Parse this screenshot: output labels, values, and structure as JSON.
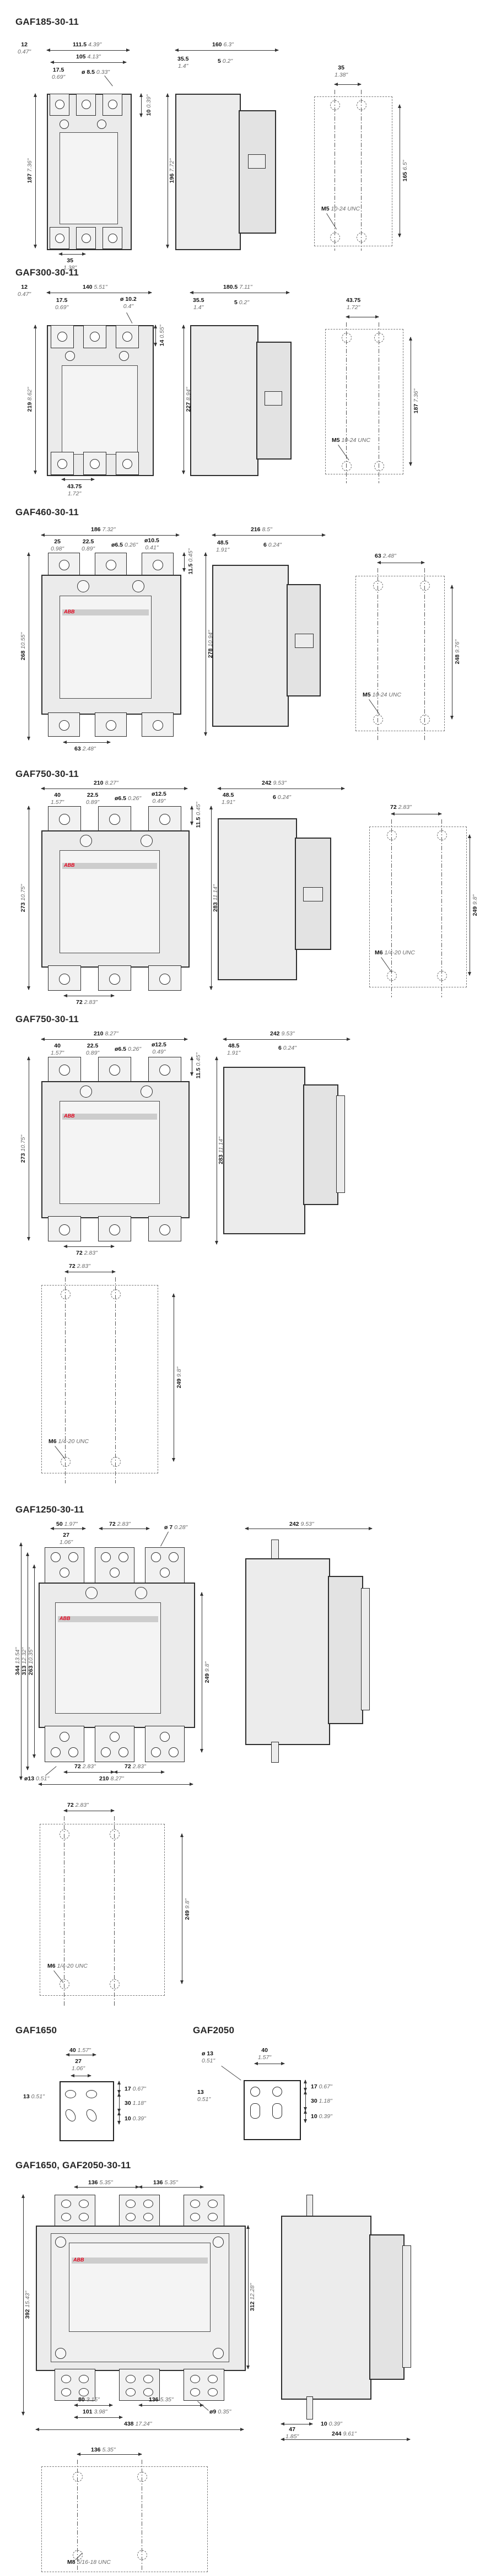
{
  "page": {
    "bg": "#ffffff",
    "ink": "#2e2e2e",
    "fill": "#ebebeb",
    "accent_red": "#e2001a",
    "logo": "ABB"
  },
  "sections": [
    {
      "title": "GAF185-30-11",
      "front": {
        "off": [
          "12",
          "0.47\""
        ],
        "w1": [
          "111.5",
          "4.39\""
        ],
        "w2": [
          "105",
          "4.13\""
        ],
        "pitch": [
          "17.5",
          "0.69\""
        ],
        "hole": [
          "ø 8.5",
          "0.33\""
        ],
        "top": [
          "10",
          "0.39\""
        ],
        "h": [
          "187",
          "7.36\""
        ],
        "bot": [
          "35",
          "1.38\""
        ]
      },
      "side": {
        "w": [
          "160",
          "6.3\""
        ],
        "a": [
          "35.5",
          "1.4\""
        ],
        "b": [
          "5",
          "0.2\""
        ],
        "h": [
          "196",
          "7.72\""
        ]
      },
      "mount": {
        "pitch": [
          "35",
          "1.38\""
        ],
        "h": [
          "165",
          "6.5\""
        ],
        "thread": [
          "M5",
          "10-24 UNC"
        ]
      }
    },
    {
      "title": "GAF300-30-11",
      "front": {
        "off": [
          "12",
          "0.47\""
        ],
        "w1": [
          "140",
          "5.51\""
        ],
        "pitch": [
          "17.5",
          "0.69\""
        ],
        "hole": [
          "ø 10.2",
          "0.4\""
        ],
        "top": [
          "14",
          "0.55\""
        ],
        "h": [
          "219",
          "8.62\""
        ],
        "bot": [
          "43.75",
          "1.72\""
        ]
      },
      "side": {
        "w": [
          "180.5",
          "7.11\""
        ],
        "a": [
          "35.5",
          "1.4\""
        ],
        "b": [
          "5",
          "0.2\""
        ],
        "h": [
          "227",
          "8.94\""
        ]
      },
      "mount": {
        "pitch": [
          "43.75",
          "1.72\""
        ],
        "h": [
          "187",
          "7.36\""
        ],
        "thread": [
          "M5",
          "10-24 UNC"
        ]
      }
    },
    {
      "title": "GAF460-30-11",
      "front": {
        "w1": [
          "186",
          "7.32\""
        ],
        "p1": [
          "25",
          "0.98\""
        ],
        "p2": [
          "22.5",
          "0.89\""
        ],
        "hole1": [
          "ø6.5",
          "0.26\""
        ],
        "hole2": [
          "ø10.5",
          "0.41\""
        ],
        "top": [
          "11.5",
          "0.45\""
        ],
        "h": [
          "268",
          "10.55\""
        ],
        "bot": [
          "63",
          "2.48\""
        ]
      },
      "side": {
        "w": [
          "216",
          "8.5\""
        ],
        "a": [
          "48.5",
          "1.91\""
        ],
        "b": [
          "6",
          "0.24\""
        ],
        "h": [
          "278",
          "10.94\""
        ]
      },
      "mount": {
        "pitch": [
          "63",
          "2.48\""
        ],
        "h": [
          "248",
          "9.76\""
        ],
        "thread": [
          "M5",
          "10-24 UNC"
        ]
      }
    },
    {
      "title": "GAF750-30-11",
      "front": {
        "w1": [
          "210",
          "8.27\""
        ],
        "p1": [
          "40",
          "1.57\""
        ],
        "p2": [
          "22.5",
          "0.89\""
        ],
        "hole1": [
          "ø6.5",
          "0.26\""
        ],
        "hole2": [
          "ø12.5",
          "0.49\""
        ],
        "top": [
          "11.5",
          "0.45\""
        ],
        "h": [
          "273",
          "10.75\""
        ],
        "bot": [
          "72",
          "2.83\""
        ]
      },
      "side": {
        "w": [
          "242",
          "9.53\""
        ],
        "a": [
          "48.5",
          "1.91\""
        ],
        "b": [
          "6",
          "0.24\""
        ],
        "h": [
          "283",
          "11.14\""
        ]
      },
      "mount": {
        "pitch": [
          "72",
          "2.83\""
        ],
        "h": [
          "249",
          "9.8\""
        ],
        "thread": [
          "M6",
          "1/4-20 UNC"
        ]
      }
    },
    {
      "title": "GAF750-30-11",
      "front": {
        "w1": [
          "210",
          "8.27\""
        ],
        "p1": [
          "40",
          "1.57\""
        ],
        "p2": [
          "22.5",
          "0.89\""
        ],
        "hole1": [
          "ø6.5",
          "0.26\""
        ],
        "hole2": [
          "ø12.5",
          "0.49\""
        ],
        "top": [
          "11.5",
          "0.45\""
        ],
        "h": [
          "273",
          "10.75\""
        ],
        "bot": [
          "72",
          "2.83\""
        ]
      },
      "side": {
        "w": [
          "242",
          "9.53\""
        ],
        "a": [
          "48.5",
          "1.91\""
        ],
        "b": [
          "6",
          "0.24\""
        ],
        "h": [
          "283",
          "11.14\""
        ]
      },
      "mount": {
        "pitch": [
          "72",
          "2.83\""
        ],
        "h": [
          "249",
          "9.8\""
        ],
        "thread": [
          "M6",
          "1/4-20 UNC"
        ]
      }
    },
    {
      "title": "GAF1250-30-11",
      "front": {
        "p50": [
          "50",
          "1.97\""
        ],
        "p27": [
          "27",
          "1.06\""
        ],
        "p72": [
          "72",
          "2.83\""
        ],
        "hole7": [
          "ø 7",
          "0.28\""
        ],
        "h344": [
          "344",
          "13.54\""
        ],
        "h313": [
          "313",
          "12.32\""
        ],
        "h263": [
          "263",
          "10.35\""
        ],
        "h249": [
          "249",
          "9.8\""
        ],
        "hole13": [
          "ø13",
          "0.51\""
        ],
        "b72a": [
          "72",
          "2.83\""
        ],
        "b72b": [
          "72",
          "2.83\""
        ],
        "w210": [
          "210",
          "8.27\""
        ]
      },
      "side": {
        "w": [
          "242",
          "9.53\""
        ]
      },
      "mount": {
        "pitch": [
          "72",
          "2.83\""
        ],
        "h": [
          "249",
          "9.8\""
        ],
        "thread": [
          "M6",
          "1/4-20 UNC"
        ]
      }
    },
    {
      "t1650": {
        "title": "GAF1650",
        "p40": [
          "40",
          "1.57\""
        ],
        "p27": [
          "27",
          "1.06\""
        ],
        "d13": [
          "13",
          "0.51\""
        ],
        "r17": [
          "17",
          "0.67\""
        ],
        "r30": [
          "30",
          "1.18\""
        ],
        "r10": [
          "10",
          "0.39\""
        ]
      },
      "t2050": {
        "title": "GAF2050",
        "hole13": [
          "ø 13",
          "0.51\""
        ],
        "p40": [
          "40",
          "1.57\""
        ],
        "d13": [
          "13",
          "0.51\""
        ],
        "r17": [
          "17",
          "0.67\""
        ],
        "r30": [
          "30",
          "1.18\""
        ],
        "r10": [
          "10",
          "0.39\""
        ]
      }
    },
    {
      "title": "GAF1650, GAF2050-30-11",
      "front": {
        "w136a": [
          "136",
          "5.35\""
        ],
        "w136b": [
          "136",
          "5.35\""
        ],
        "h392": [
          "392",
          "15.43\""
        ],
        "h312": [
          "312",
          "12.28\""
        ],
        "b80": [
          "80",
          "3.15\""
        ],
        "b101": [
          "101",
          "3.98\""
        ],
        "b136": [
          "136",
          "5.35\""
        ],
        "hole9": [
          "ø9",
          "0.35\""
        ],
        "w438": [
          "438",
          "17.24\""
        ]
      },
      "side": {
        "a47": [
          "47",
          "1.85\""
        ],
        "b10": [
          "10",
          "0.39\""
        ],
        "w244": [
          "244",
          "9.61\""
        ]
      },
      "mount": {
        "pitch": [
          "136",
          "5.35\""
        ],
        "thread": [
          "M8",
          "5/16-18 UNC"
        ]
      }
    }
  ]
}
